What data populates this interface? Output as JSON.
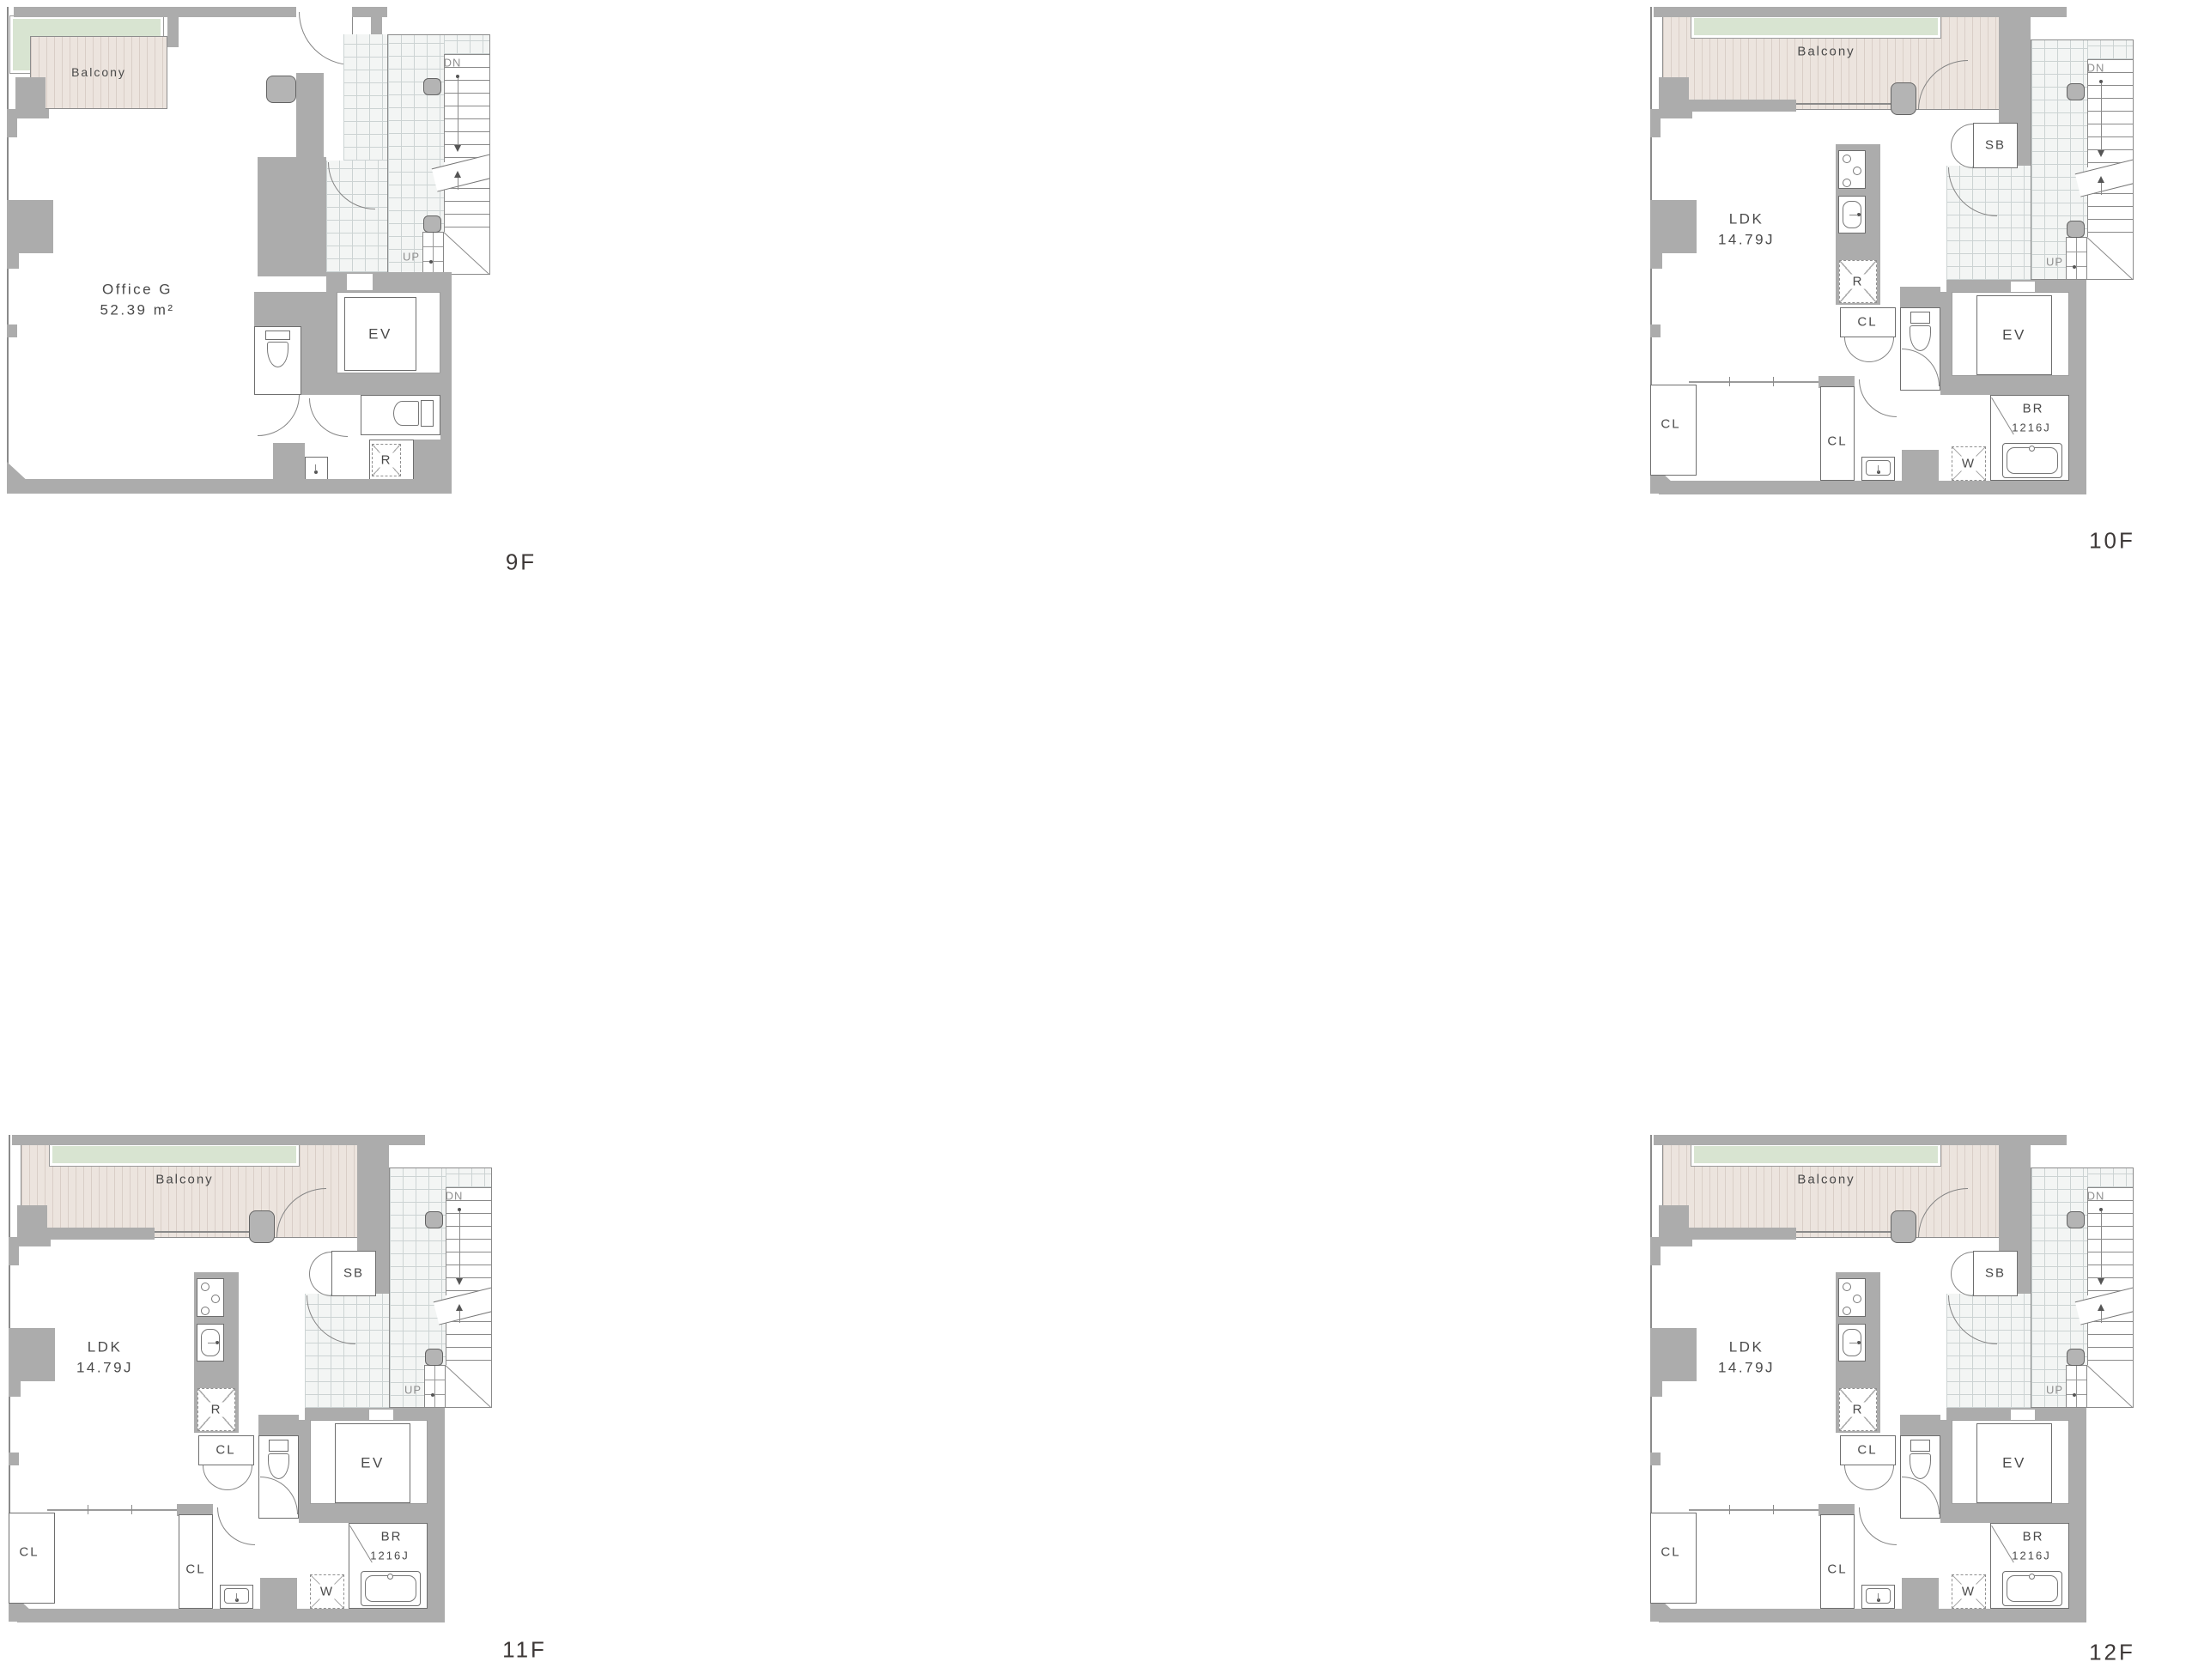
{
  "floors": [
    {
      "label": "9F",
      "unit": "Office G",
      "area": "52.39 m²"
    },
    {
      "label": "10F",
      "unit": "LDK",
      "area": "14.79J"
    },
    {
      "label": "11F",
      "unit": "LDK",
      "area": "14.79J"
    },
    {
      "label": "12F",
      "unit": "LDK",
      "area": "14.79J"
    }
  ],
  "shared": {
    "balcony": "Balcony",
    "stairs_down": "DN",
    "stairs_up": "UP",
    "elevator": "EV",
    "shoe_box": "SB",
    "closet": "CL",
    "refrigerator": "R",
    "washer": "W",
    "bath": "BR",
    "bath_size": "1216J"
  },
  "colors": {
    "wall": "#acacac",
    "balcony_fill": "#ece4de",
    "planter_fill": "#d8e4d1",
    "tile_fill": "#f3f5f4",
    "text": "#4a4a4a"
  }
}
